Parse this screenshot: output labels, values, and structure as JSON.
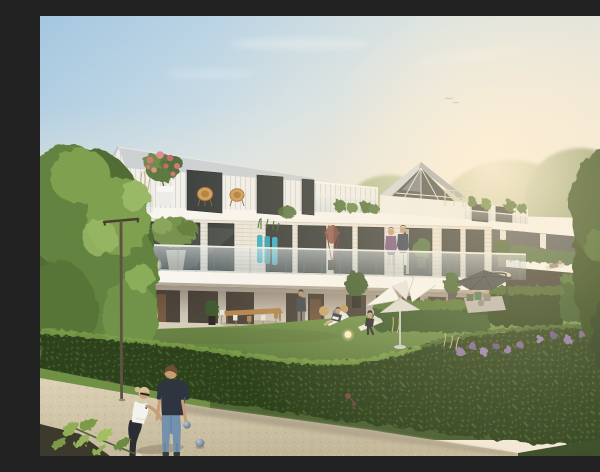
{
  "scene": {
    "caption": "Sunlit architectural rendering of a modern white apartment residence with two gabled roof volumes, set-back attic, planted balconies with glass balustrades, garden terraces behind clipped hedges, parasols and loungers on the lawn, and a man and a woman playing petanque on a gravel path in the foreground under a large tree and a street lamp.",
    "sky": "clear gradient sky, blue upper left turning warm cream toward the right horizon, two tiny distant birds",
    "people": [
      "woman in white t-shirt and dark trousers bending to throw a petanque boule",
      "man in dark navy polo and blue jeans holding a boule",
      "couple standing on first-floor balcony",
      "resident standing on ground-floor terrace",
      "man reclining on white lounger with laptop",
      "woman in black seated on white lounger",
      "group of three seated under dark grey cantilever parasol",
      "person lying on the lawn near the right wing"
    ],
    "objects": [
      "white origami folding parasol",
      "dark grey cantilever parasol",
      "beige parasol",
      "glowing ball garden lamp",
      "teal plant columns",
      "pink oleander in white pot",
      "two orange acapulco chairs",
      "rooftop pergola",
      "long wooden dining table with chairs",
      "street lamp",
      "petanque boules",
      "plane-tree leaf branch"
    ]
  },
  "palette": {
    "sky-top": "#a4c7e0",
    "sky-mid": "#d5e2e7",
    "sky-warm": "#f2e8d7",
    "sun-glow": "#fdf4e3",
    "roof-light": "#cdd1d2",
    "roof-dark": "#a7adb0",
    "siding": "#f1efe9",
    "slab": "#f8f5ee",
    "wall": "#ece5d8",
    "window": "#3f423f",
    "glass": "#b9cdd2",
    "interior": "#8a6647",
    "soffit": "#efe7d7",
    "hedge-dark": "#2d421f",
    "hedge-mid": "#3e5a2a",
    "hedge-light": "#5d7d39",
    "hedge-sun": "#7ba04a",
    "grass-sun": "#7a9b4e",
    "grass-shade": "#43592d",
    "path": "#d5c9ab",
    "path-shadow": "#a89d85",
    "tree-dark": "#516d36",
    "tree-mid": "#64843f",
    "tree-light": "#7fa04f",
    "tree-high": "#99b966",
    "tree-right": "#33491f",
    "lamp": "#5d5244",
    "parasol-white": "#f3f1ea",
    "parasol-gray": "#474c4b",
    "teal": "#3fb0c4",
    "oleander": "#d4767a",
    "olive": "#77934f",
    "rattan": "#d2a05f",
    "skin": "#c79c76",
    "hair-brown": "#6b4f33",
    "hair-blonde": "#d9c392",
    "polo": "#2e3440",
    "jeans": "#7390ad",
    "shirt": "#f4f2ed",
    "pants": "#2c2d33",
    "purple-top": "#7b5c82",
    "navy-top": "#3c4658",
    "boule": "#8c99ab",
    "lamp-glow": "#ffecc0",
    "flower-purple": "#8d76a3"
  }
}
